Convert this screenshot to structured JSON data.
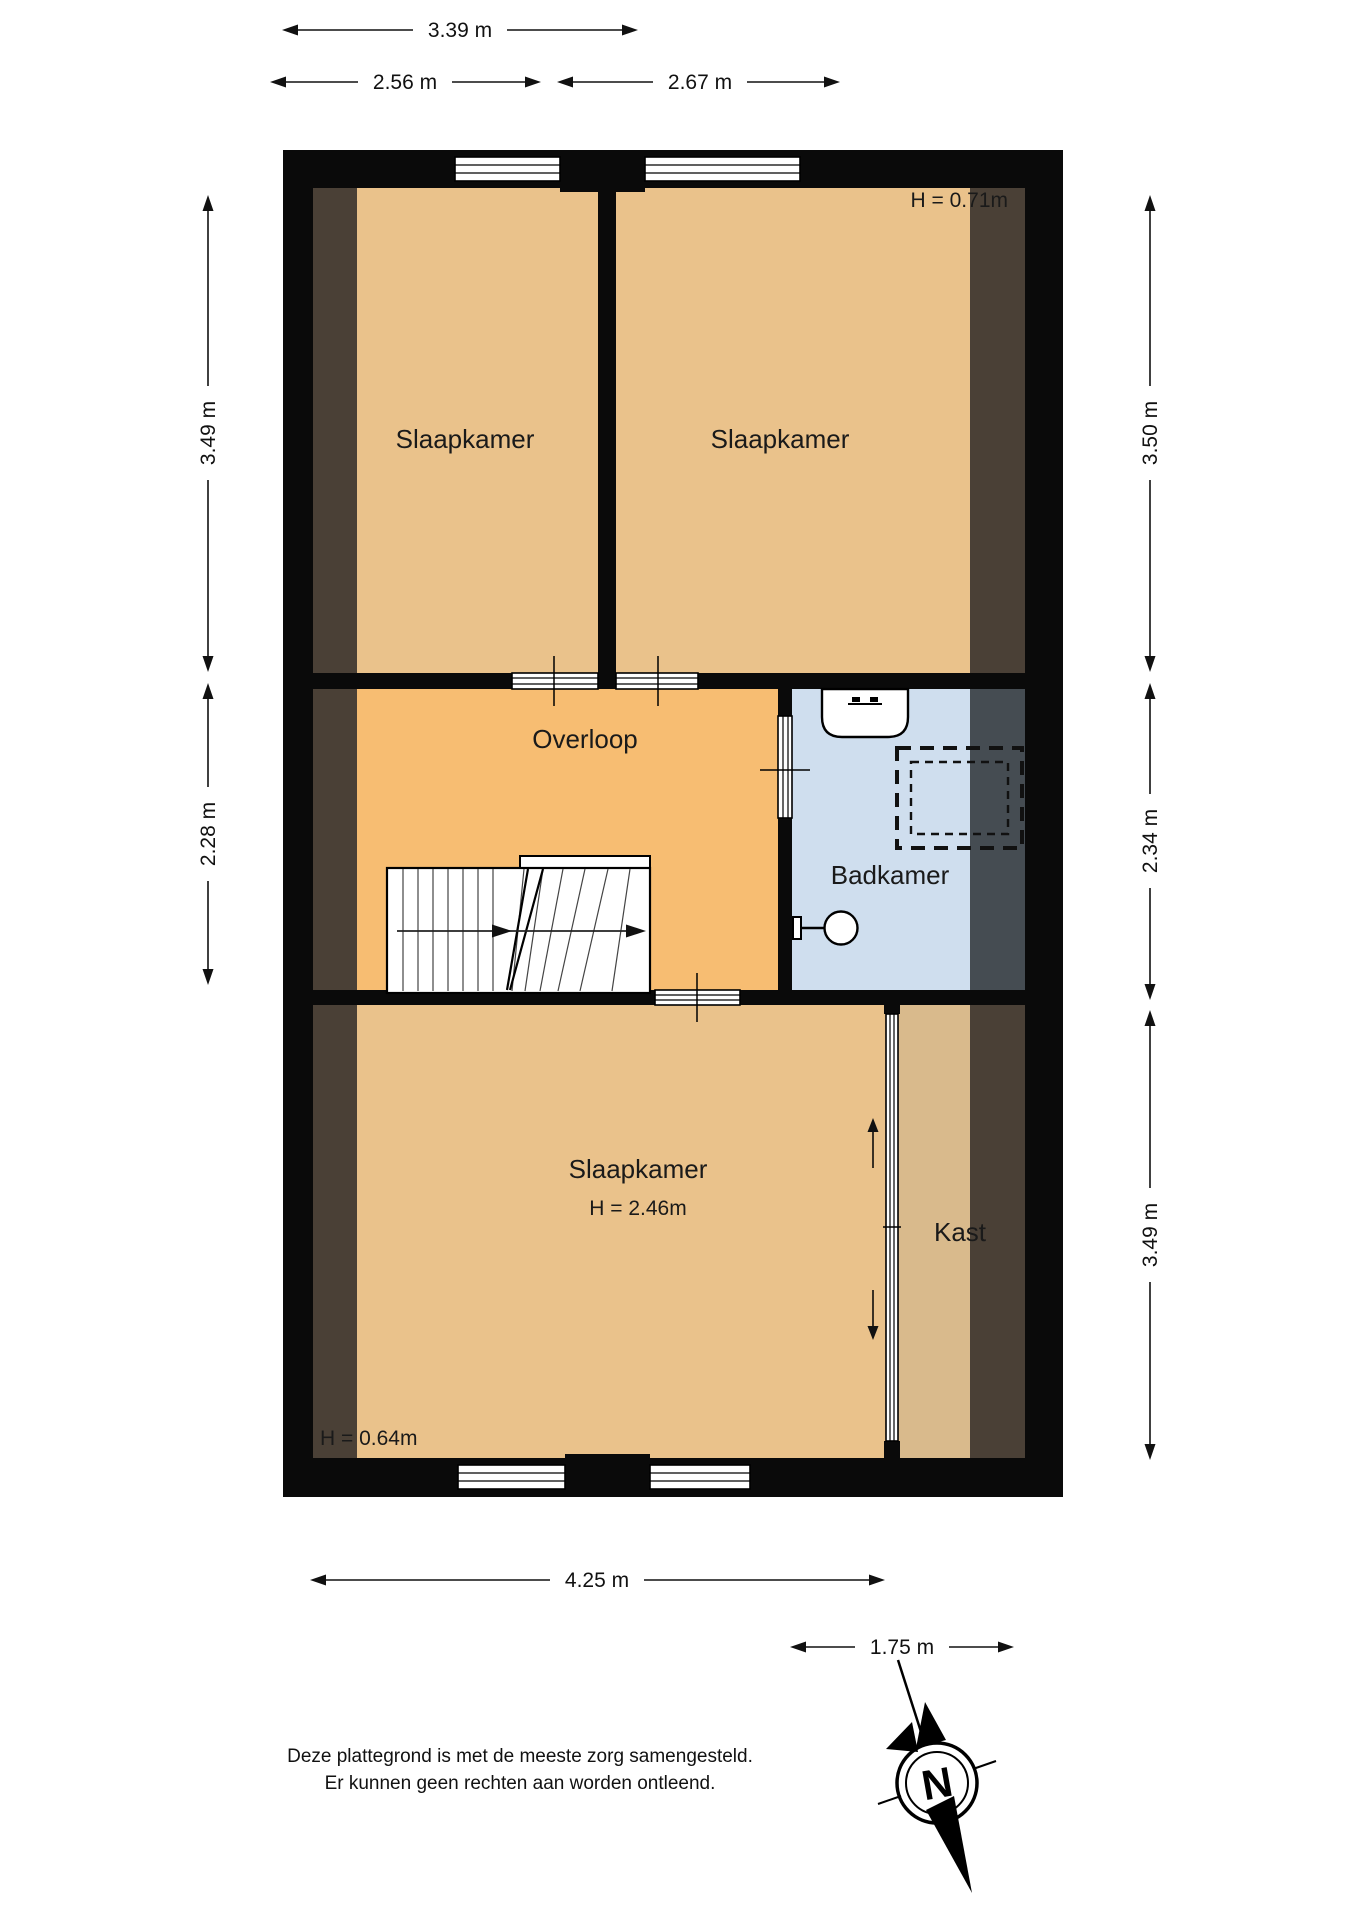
{
  "rooms": {
    "bedroom_top_left": {
      "label": "Slaapkamer"
    },
    "bedroom_top_right": {
      "label": "Slaapkamer",
      "height_note": "H = 0.71m"
    },
    "overloop": {
      "label": "Overloop"
    },
    "badkamer": {
      "label": "Badkamer"
    },
    "bedroom_bottom": {
      "label": "Slaapkamer",
      "height_note": "H = 2.46m",
      "low_height_note": "H = 0.64m"
    },
    "kast": {
      "label": "Kast"
    }
  },
  "dimensions": {
    "top_total": "3.39 m",
    "top_left": "2.56 m",
    "top_right": "2.67 m",
    "side_left_upper": "3.49 m",
    "side_left_middle": "2.28 m",
    "side_right_upper": "3.50 m",
    "side_right_middle": "2.34 m",
    "side_right_lower": "3.49 m",
    "bottom_main": "4.25 m",
    "bottom_closet": "1.75 m"
  },
  "compass": {
    "north_label": "N"
  },
  "disclaimer": {
    "line1": "Deze plattegrond is met de meeste zorg samengesteld.",
    "line2": "Er kunnen geen rechten aan worden ontleend."
  },
  "colors": {
    "bedroom": "#eac28b",
    "overloop": "#f7bd72",
    "badkamer": "#cfdeee",
    "kast": "#d9ba8c",
    "attic_brown": "#4a4036",
    "attic_slate": "#454c52",
    "wall": "#0a0a0a"
  }
}
